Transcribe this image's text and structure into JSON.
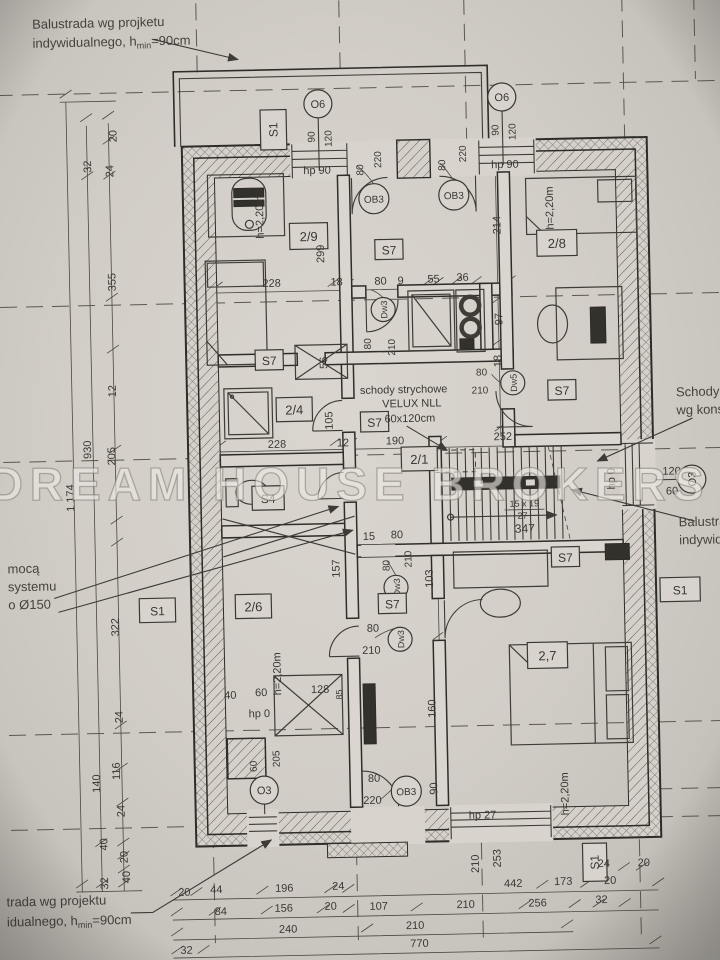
{
  "watermark": "DREAM HOUSE BROKERS",
  "notes": {
    "balustrade_top_1": "Balustrada wg projketu",
    "balustrade_top_2a": "indywidualnego, h",
    "sub_min": "min",
    "balustrade_top_2c": "=90cm",
    "balustrade_bottom_1": "trada wg projektu",
    "balustrade_bottom_2a": "idualnego, h",
    "balustrade_bottom_2c": "=90cm",
    "vent_1": "mocą",
    "vent_2": "systemu",
    "vent_3": "o Ø150",
    "stairs_right_1": "Schody ż",
    "stairs_right_2": "wg konstr",
    "balustrade_right_1": "Balustrad",
    "balustrade_right_2": "indywidua",
    "attic_1": "schody strychowe",
    "attic_2": "VELUX NLL",
    "attic_3": "60x120cm"
  },
  "rooms": {
    "r29": "2/9",
    "r28": "2/8",
    "r27": "2,7",
    "r26": "2/6",
    "r24": "2/4",
    "r21": "2/1"
  },
  "tags": {
    "s1": "S1",
    "s7": "S7",
    "s4": "S4",
    "o6": "O6",
    "o3": "O3",
    "ob3": "OB3",
    "dw3": "Dw3",
    "dw5": "Dw5"
  },
  "sills": {
    "hp90": "hp 90",
    "hp27": "hp 27",
    "hp0": "hp 0"
  },
  "stairs": {
    "tread": "15 x 19",
    "riser": "27",
    "run": "347",
    "flight": "252",
    "width": "190"
  },
  "labels": {
    "height_220": "h=2,20m"
  },
  "dims": {
    "n9": "9",
    "n12": "12",
    "n15": "15",
    "n18": "18",
    "n20": "20",
    "n24": "24",
    "n27": "27",
    "n32": "32",
    "n36": "36",
    "n40": "40",
    "n44": "44",
    "n55": "55",
    "n56": "56",
    "n60": "60",
    "n80": "80",
    "n84": "84",
    "n85": "85",
    "n90": "90",
    "n97": "97",
    "n103": "103",
    "n105": "105",
    "n107": "107",
    "n116": "116",
    "n120": "120",
    "n128": "128",
    "n140": "140",
    "n156": "156",
    "n157": "157",
    "n160": "160",
    "n173": "173",
    "n190": "190",
    "n196": "196",
    "n205": "205",
    "n210": "210",
    "n214": "214",
    "n220": "220",
    "n228": "228",
    "n240": "240",
    "n252": "252",
    "n253": "253",
    "n256": "256",
    "n299": "299",
    "n322": "322",
    "n347": "347",
    "n355": "355",
    "n442": "442",
    "n770": "770",
    "n930": "930",
    "n1174": "1 174"
  }
}
